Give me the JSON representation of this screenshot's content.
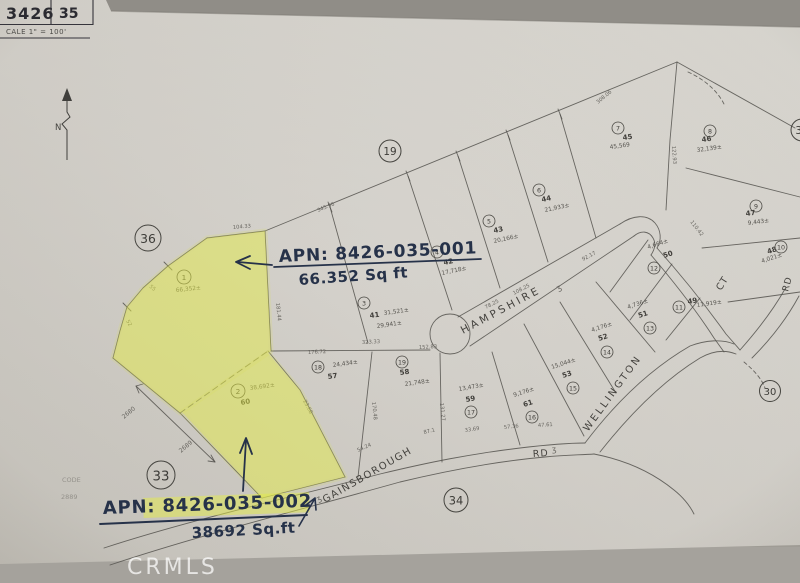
{
  "scan": {
    "watermark": "CRMLS",
    "title_block": {
      "book": "3426",
      "page": "35",
      "scale_label": "CALE 1\" = 100'"
    },
    "north_label": "N",
    "faint_code": {
      "line1": "CODE",
      "line2": "2889"
    },
    "paper_color": "#d6d3cd",
    "background_color": "#9f9c95"
  },
  "annotations": {
    "ink_color": "#25304a",
    "highlight_color": "#e4eb48",
    "apn1_label": "APN: 8426-035-001",
    "apn1_area": "66.352 Sq ft",
    "apn2_label": "APN: 8426-035-002",
    "apn2_area": "38692 Sq.ft"
  },
  "map": {
    "street_labels": [
      {
        "t": "HAMPSHIRE",
        "x": 463,
        "y": 334,
        "rot": -28,
        "size": 10.5,
        "ls": 3
      },
      {
        "t": "WELLINGTON",
        "x": 588,
        "y": 432,
        "rot": -54,
        "size": 10,
        "ls": 2.5
      },
      {
        "t": "GAINSBOROUGH",
        "x": 325,
        "y": 503,
        "rot": -30,
        "size": 10,
        "ls": 1.5
      },
      {
        "t": "RD",
        "x": 533,
        "y": 457,
        "rot": -4,
        "size": 9.5,
        "ls": 1
      },
      {
        "t": "CT",
        "x": 721,
        "y": 291,
        "rot": -58,
        "size": 9.5,
        "ls": 1
      },
      {
        "t": "RD",
        "x": 788,
        "y": 292,
        "rot": -75,
        "size": 9,
        "ls": 1
      }
    ],
    "sheet_circles": [
      {
        "n": "36",
        "x": 148,
        "y": 238,
        "r": 13
      },
      {
        "n": "19",
        "x": 390,
        "y": 151,
        "r": 11
      },
      {
        "n": "33",
        "x": 161,
        "y": 475,
        "r": 14
      },
      {
        "n": "34",
        "x": 456,
        "y": 500,
        "r": 12
      },
      {
        "n": "30",
        "x": 770,
        "y": 391,
        "r": 10.5
      },
      {
        "n": "35",
        "x": 802,
        "y": 130,
        "r": 11
      }
    ],
    "parcel_circles": [
      {
        "n": "1",
        "x": 184,
        "y": 277,
        "r": 7
      },
      {
        "n": "2",
        "x": 238,
        "y": 391,
        "r": 7
      },
      {
        "n": "3",
        "x": 364,
        "y": 303,
        "r": 6
      },
      {
        "n": "4",
        "x": 437,
        "y": 252,
        "r": 6
      },
      {
        "n": "5",
        "x": 489,
        "y": 221,
        "r": 6
      },
      {
        "n": "6",
        "x": 539,
        "y": 190,
        "r": 6
      },
      {
        "n": "7",
        "x": 618,
        "y": 128,
        "r": 6
      },
      {
        "n": "8",
        "x": 710,
        "y": 131,
        "r": 6
      },
      {
        "n": "9",
        "x": 756,
        "y": 206,
        "r": 6
      },
      {
        "n": "10",
        "x": 781,
        "y": 247,
        "r": 6
      },
      {
        "n": "11",
        "x": 679,
        "y": 307,
        "r": 6
      },
      {
        "n": "12",
        "x": 654,
        "y": 268,
        "r": 6
      },
      {
        "n": "13",
        "x": 650,
        "y": 328,
        "r": 6
      },
      {
        "n": "14",
        "x": 607,
        "y": 352,
        "r": 6
      },
      {
        "n": "15",
        "x": 573,
        "y": 388,
        "r": 6
      },
      {
        "n": "16",
        "x": 532,
        "y": 417,
        "r": 6
      },
      {
        "n": "17",
        "x": 471,
        "y": 412,
        "r": 6
      },
      {
        "n": "18",
        "x": 318,
        "y": 367,
        "r": 6
      },
      {
        "n": "19",
        "x": 402,
        "y": 362,
        "r": 6
      }
    ],
    "lot_labels": [
      {
        "t": "41",
        "x": 370,
        "y": 318,
        "rot": -8
      },
      {
        "t": "42",
        "x": 444,
        "y": 265,
        "rot": -12
      },
      {
        "t": "43",
        "x": 494,
        "y": 233,
        "rot": -12
      },
      {
        "t": "44",
        "x": 542,
        "y": 202,
        "rot": -12
      },
      {
        "t": "45",
        "x": 623,
        "y": 140,
        "rot": -8
      },
      {
        "t": "46",
        "x": 702,
        "y": 142,
        "rot": -8
      },
      {
        "t": "47",
        "x": 746,
        "y": 216,
        "rot": -8
      },
      {
        "t": "48",
        "x": 768,
        "y": 254,
        "rot": -18
      },
      {
        "t": "49",
        "x": 688,
        "y": 304,
        "rot": -10
      },
      {
        "t": "50",
        "x": 664,
        "y": 258,
        "rot": -18
      },
      {
        "t": "51",
        "x": 639,
        "y": 318,
        "rot": -18
      },
      {
        "t": "52",
        "x": 599,
        "y": 341,
        "rot": -18
      },
      {
        "t": "53",
        "x": 563,
        "y": 378,
        "rot": -18
      },
      {
        "t": "61",
        "x": 524,
        "y": 407,
        "rot": -18
      },
      {
        "t": "59",
        "x": 466,
        "y": 402,
        "rot": -10
      },
      {
        "t": "57",
        "x": 328,
        "y": 379,
        "rot": -8
      },
      {
        "t": "58",
        "x": 400,
        "y": 375,
        "rot": -8
      },
      {
        "t": "60",
        "x": 241,
        "y": 405,
        "rot": -10
      }
    ],
    "area_labels": [
      {
        "t": "66,352±",
        "x": 176,
        "y": 292,
        "rot": -6
      },
      {
        "t": "38,692±",
        "x": 250,
        "y": 390,
        "rot": -8
      },
      {
        "t": "31,521±",
        "x": 384,
        "y": 315,
        "rot": -8
      },
      {
        "t": "29,941±",
        "x": 377,
        "y": 328,
        "rot": -8
      },
      {
        "t": "17,718±",
        "x": 442,
        "y": 275,
        "rot": -12
      },
      {
        "t": "20,166±",
        "x": 494,
        "y": 243,
        "rot": -12
      },
      {
        "t": "21,933±",
        "x": 545,
        "y": 212,
        "rot": -12
      },
      {
        "t": "45,569",
        "x": 610,
        "y": 149,
        "rot": -8
      },
      {
        "t": "32,139±",
        "x": 697,
        "y": 152,
        "rot": -8
      },
      {
        "t": "9,443±",
        "x": 748,
        "y": 225,
        "rot": -8
      },
      {
        "t": "4,021±",
        "x": 762,
        "y": 263,
        "rot": -18
      },
      {
        "t": "11,919±",
        "x": 697,
        "y": 307,
        "rot": -8
      },
      {
        "t": "4,664±",
        "x": 648,
        "y": 249,
        "rot": -18
      },
      {
        "t": "4,736±",
        "x": 628,
        "y": 309,
        "rot": -18
      },
      {
        "t": "4,176±",
        "x": 592,
        "y": 332,
        "rot": -18
      },
      {
        "t": "15,044±",
        "x": 552,
        "y": 369,
        "rot": -18
      },
      {
        "t": "9,176±",
        "x": 514,
        "y": 397,
        "rot": -18
      },
      {
        "t": "13,473±",
        "x": 459,
        "y": 391,
        "rot": -10
      },
      {
        "t": "24,434±",
        "x": 333,
        "y": 367,
        "rot": -8
      },
      {
        "t": "21,748±",
        "x": 405,
        "y": 386,
        "rot": -8
      }
    ],
    "dim_labels": [
      {
        "t": "2680",
        "x": 124,
        "y": 419,
        "rot": -40,
        "size": 6
      },
      {
        "t": "2689",
        "x": 181,
        "y": 453,
        "rot": -40,
        "size": 6
      },
      {
        "t": "104.33",
        "x": 233,
        "y": 229,
        "rot": -5
      },
      {
        "t": "181.44",
        "x": 276,
        "y": 303,
        "rot": 84
      },
      {
        "t": "345.96",
        "x": 318,
        "y": 212,
        "rot": -22
      },
      {
        "t": "308.06",
        "x": 598,
        "y": 104,
        "rot": -40
      },
      {
        "t": "122.93",
        "x": 672,
        "y": 146,
        "rot": 86
      },
      {
        "t": "176.72",
        "x": 308,
        "y": 354,
        "rot": -3
      },
      {
        "t": "323.33",
        "x": 362,
        "y": 344,
        "rot": -3
      },
      {
        "t": "152.83",
        "x": 419,
        "y": 349,
        "rot": -3
      },
      {
        "t": "23.68",
        "x": 303,
        "y": 401,
        "rot": 62
      },
      {
        "t": "54.24",
        "x": 358,
        "y": 452,
        "rot": -24
      },
      {
        "t": "87.1",
        "x": 424,
        "y": 434,
        "rot": -14
      },
      {
        "t": "33.69",
        "x": 465,
        "y": 432,
        "rot": -9
      },
      {
        "t": "57.36",
        "x": 504,
        "y": 429,
        "rot": -6
      },
      {
        "t": "47.61",
        "x": 538,
        "y": 427,
        "rot": -4
      },
      {
        "t": "78.25",
        "x": 486,
        "y": 309,
        "rot": -28
      },
      {
        "t": "108.25",
        "x": 514,
        "y": 295,
        "rot": -28
      },
      {
        "t": "92.17",
        "x": 583,
        "y": 261,
        "rot": -28
      },
      {
        "t": "170.48",
        "x": 372,
        "y": 402,
        "rot": 84
      },
      {
        "t": "131.27",
        "x": 440,
        "y": 403,
        "rot": 84
      },
      {
        "t": "110.42",
        "x": 690,
        "y": 222,
        "rot": 52
      },
      {
        "t": "55",
        "x": 149,
        "y": 287,
        "rot": 40
      },
      {
        "t": "52",
        "x": 126,
        "y": 321,
        "rot": 60
      },
      {
        "t": "ʒ",
        "x": 558,
        "y": 291,
        "rot": -28,
        "size": 8
      },
      {
        "t": "ʒ",
        "x": 318,
        "y": 502,
        "rot": -30,
        "size": 8
      },
      {
        "t": "ʒ",
        "x": 552,
        "y": 452,
        "rot": -5,
        "size": 8
      }
    ]
  }
}
